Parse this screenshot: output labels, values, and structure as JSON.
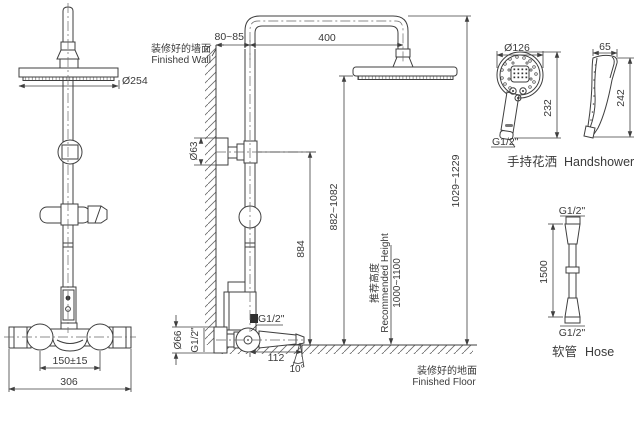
{
  "colors": {
    "line": "#3f3f3f",
    "text": "#3a3a3a",
    "background": "#ffffff"
  },
  "front_view": {
    "head_diameter": "Ø254",
    "handle_spacing": "150±15",
    "body_width": "306"
  },
  "side_view": {
    "wall_cn": "装修好的墙面",
    "wall_en": "Finished Wall",
    "wall_offset": "80~85",
    "arm_reach": "400",
    "escutcheon_dia": "Ø63",
    "valve_center_height": "884",
    "head_face_height": "882~1082",
    "overall_height": "1029~1229",
    "outlet_thread": "G1/2\"",
    "inlet_escutcheon_dia": "Ø66",
    "inlet_thread": "G1/2\"",
    "spout_reach": "112",
    "spout_angle": "10°",
    "rec_cn": "推荐高度",
    "rec_en": "Recommended Height",
    "rec_range": "1000~1100",
    "floor_cn": "装修好的地面",
    "floor_en": "Finished Floor"
  },
  "handshower": {
    "face_dia": "Ø126",
    "height_front": "232",
    "width_side": "65",
    "height_side": "242",
    "thread": "G1/2\"",
    "label_cn": "手持花洒",
    "label_en": "Handshower"
  },
  "hose": {
    "thread_top": "G1/2\"",
    "thread_bottom": "G1/2\"",
    "length": "1500",
    "label_cn": "软管",
    "label_en": "Hose"
  }
}
